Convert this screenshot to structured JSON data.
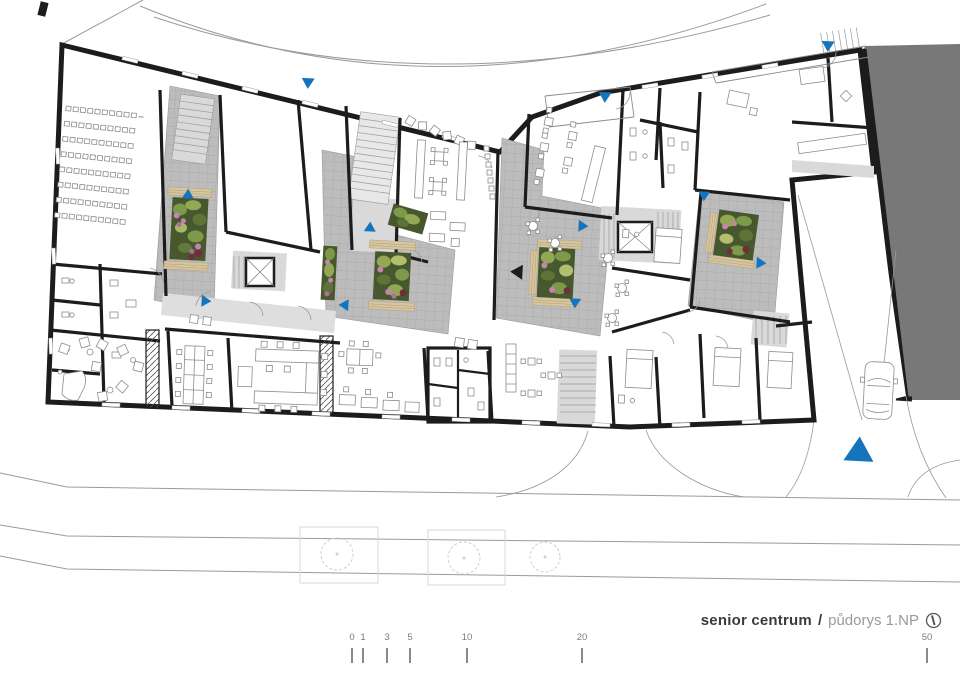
{
  "title": {
    "project": "senior centrum",
    "separator": "/",
    "drawing": "půdorys 1.NP"
  },
  "north_indicator": "north-arrow-circle",
  "scale_bar": {
    "units": "meters",
    "ticks": [
      {
        "label": "0",
        "x": 352
      },
      {
        "label": "1",
        "x": 363
      },
      {
        "label": "3",
        "x": 387
      },
      {
        "label": "5",
        "x": 410
      },
      {
        "label": "10",
        "x": 467
      },
      {
        "label": "20",
        "x": 582
      },
      {
        "label": "50",
        "x": 927
      }
    ]
  },
  "colors": {
    "accent_blue": "#1474bd",
    "wall_black": "#1c1c1c",
    "courtyard_tile": "#bcbcbc",
    "adjacent_building": "#787878",
    "interior_light": "#d9d9d9",
    "bench_wood": "#d7c5a0",
    "planting_green": "#6f8a42",
    "flower_pink": "#c584ad",
    "flower_dark_red": "#6d2f3c",
    "road_line": "#9b9b9b",
    "title_dark": "#3c3c3c",
    "title_gray": "#9a9a9a"
  },
  "markers": [
    {
      "id": "entry-top-left",
      "x": 308,
      "y": 83,
      "dir": "down",
      "w": 13,
      "type": "entrance"
    },
    {
      "id": "entry-top-center",
      "x": 605,
      "y": 97,
      "dir": "down",
      "w": 13,
      "type": "entrance"
    },
    {
      "id": "entry-top-right",
      "x": 828,
      "y": 46,
      "dir": "down",
      "w": 13,
      "type": "entrance"
    },
    {
      "id": "court1-mid",
      "x": 188,
      "y": 194,
      "dir": "up",
      "w": 12,
      "type": "entrance"
    },
    {
      "id": "court1-south",
      "x": 206,
      "y": 301,
      "dir": "right",
      "w": 12,
      "type": "entrance"
    },
    {
      "id": "court2-north",
      "x": 370,
      "y": 227,
      "dir": "up",
      "w": 12,
      "type": "entrance"
    },
    {
      "id": "court2-south",
      "x": 344,
      "y": 305,
      "dir": "left",
      "w": 12,
      "type": "entrance"
    },
    {
      "id": "court3-east",
      "x": 583,
      "y": 226,
      "dir": "right",
      "w": 12,
      "type": "entrance"
    },
    {
      "id": "court3-south",
      "x": 575,
      "y": 303,
      "dir": "down",
      "w": 12,
      "type": "entrance"
    },
    {
      "id": "court4-north",
      "x": 704,
      "y": 196,
      "dir": "down",
      "w": 12,
      "type": "entrance"
    },
    {
      "id": "court4-east",
      "x": 761,
      "y": 263,
      "dir": "right",
      "w": 12,
      "type": "entrance"
    },
    {
      "id": "driveway-entry",
      "x": 859,
      "y": 450,
      "dir": "up",
      "w": 30,
      "type": "entrance"
    },
    {
      "id": "section-cut",
      "x": 517,
      "y": 272,
      "dir": "left",
      "w": 15,
      "type": "section"
    }
  ]
}
